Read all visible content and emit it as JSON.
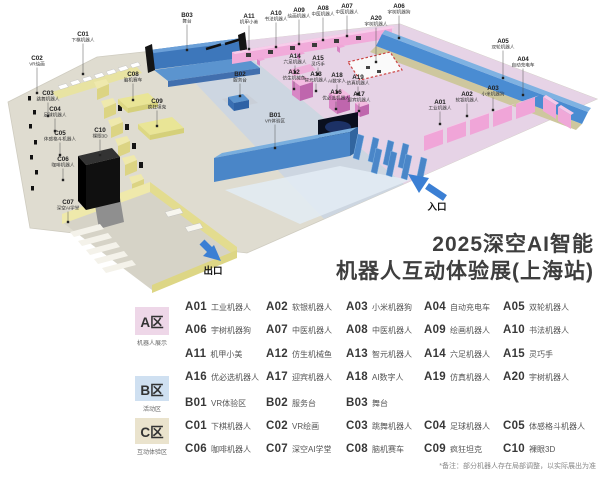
{
  "title": {
    "line1": "2025深空AI智能",
    "line2": "机器人互动体验展(上海站)"
  },
  "map": {
    "entrance_label": "入口",
    "exit_label": "出口"
  },
  "legend": {
    "zones": [
      {
        "badge": "A区",
        "sub": "机器人展示",
        "color": "#eed7e8",
        "items": [
          {
            "code": "A01",
            "name": "工业机器人"
          },
          {
            "code": "A02",
            "name": "软银机器人"
          },
          {
            "code": "A03",
            "name": "小米机器狗"
          },
          {
            "code": "A04",
            "name": "自动充电车"
          },
          {
            "code": "A05",
            "name": "双轮机器人"
          },
          {
            "code": "A06",
            "name": "宇树机器狗"
          },
          {
            "code": "A07",
            "name": "中医机器人"
          },
          {
            "code": "A08",
            "name": "中医机器人"
          },
          {
            "code": "A09",
            "name": "绘画机器人"
          },
          {
            "code": "A10",
            "name": "书法机器人"
          },
          {
            "code": "A11",
            "name": "机甲小美"
          },
          {
            "code": "A12",
            "name": "仿生机械鱼"
          },
          {
            "code": "A13",
            "name": "智元机器人"
          },
          {
            "code": "A14",
            "name": "六足机器人"
          },
          {
            "code": "A15",
            "name": "灵巧手"
          },
          {
            "code": "A16",
            "name": "优必选机器人"
          },
          {
            "code": "A17",
            "name": "迎宾机器人"
          },
          {
            "code": "A18",
            "name": "AI数字人"
          },
          {
            "code": "A19",
            "name": "仿真机器人"
          },
          {
            "code": "A20",
            "name": "宇树机器人"
          }
        ]
      },
      {
        "badge": "B区",
        "sub": "活动区",
        "color": "#cfe0f1",
        "items": [
          {
            "code": "B01",
            "name": "VR体验区"
          },
          {
            "code": "B02",
            "name": "服务台"
          },
          {
            "code": "B03",
            "name": "舞台"
          }
        ]
      },
      {
        "badge": "C区",
        "sub": "互动体验区",
        "color": "#eae3cd",
        "items": [
          {
            "code": "C01",
            "name": "下棋机器人"
          },
          {
            "code": "C02",
            "name": "VR绘画"
          },
          {
            "code": "C03",
            "name": "跳舞机器人"
          },
          {
            "code": "C04",
            "name": "足球机器人"
          },
          {
            "code": "C05",
            "name": "体感格斗机器人"
          },
          {
            "code": "C06",
            "name": "咖啡机器人"
          },
          {
            "code": "C07",
            "name": "深空AI学堂"
          },
          {
            "code": "C08",
            "name": "脑机赛车"
          },
          {
            "code": "C09",
            "name": "疯狂坦克"
          },
          {
            "code": "C10",
            "name": "裸眼3D"
          }
        ]
      }
    ],
    "note": "*备注：部分机器人存在局部调整，以实际展出为准"
  },
  "colors": {
    "accent_blue": "#4a86c8",
    "booth_pink": "#f0a5d8",
    "zone_yellow": "#ece5a0",
    "arrow_blue": "#3b7fd4",
    "title_text": "#3e3e3e"
  }
}
